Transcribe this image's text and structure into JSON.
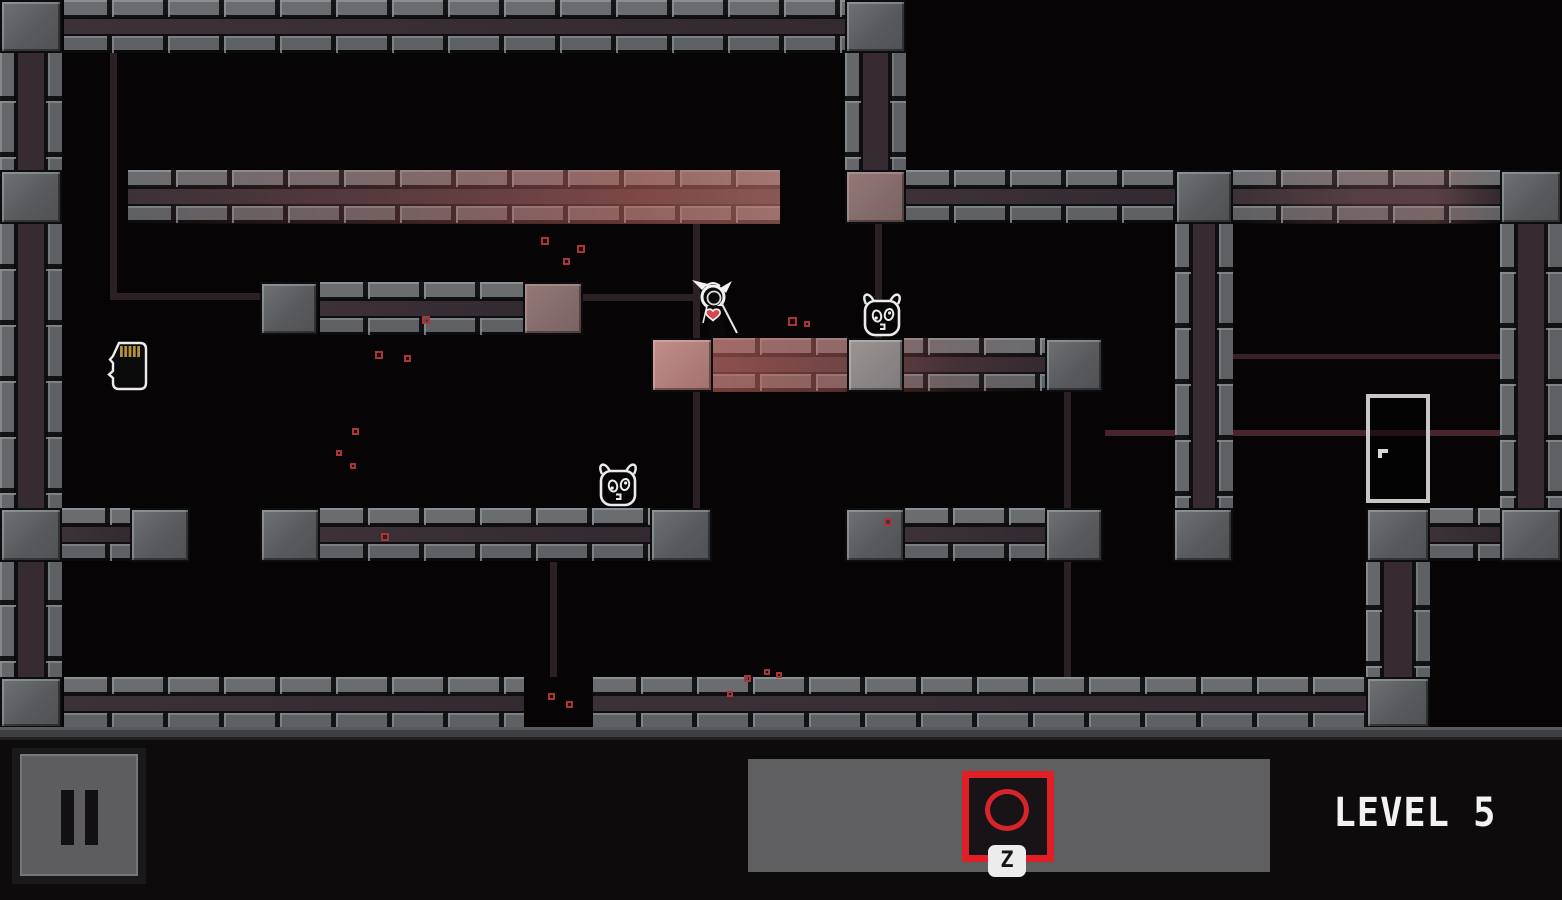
{
  "meta": {
    "width": 1562,
    "height": 900,
    "scene": "dark tiled platformer level"
  },
  "colors": {
    "background": "#060404",
    "hud_background": "#0d0b0c",
    "panel_gray": "#5f5f61",
    "accent_red": "#e11f26",
    "particle_red": "#a8353a",
    "wire_dark": "#2b2026",
    "wire_red": "#4a242c",
    "wire_red2": "#3a2028",
    "girder_gray": "#636367",
    "girder_band": "#342b31",
    "tint_pink": "#b2807c",
    "door_frame": "#c7c7c7",
    "sprite_white": "#ececec",
    "heart_red": "#d4494d",
    "pin_gold": "#b5913d"
  },
  "hud": {
    "pause_icon": "pause-icon",
    "action_icon": "circle-icon",
    "action_key": "Z",
    "level_label": "LEVEL 5"
  },
  "level": {
    "beams": [
      [
        64,
        0,
        781,
        53,
        "none"
      ],
      [
        128,
        170,
        652,
        54,
        "red-r"
      ],
      [
        906,
        170,
        269,
        54,
        "none"
      ],
      [
        1233,
        170,
        267,
        54,
        "pink-c"
      ],
      [
        320,
        282,
        203,
        53,
        "none"
      ],
      [
        712,
        338,
        333,
        54,
        "red-l"
      ],
      [
        62,
        508,
        68,
        54,
        "none"
      ],
      [
        320,
        508,
        330,
        54,
        "none"
      ],
      [
        905,
        508,
        140,
        54,
        "none"
      ],
      [
        1430,
        508,
        70,
        54,
        "none"
      ],
      [
        64,
        677,
        460,
        51,
        "none"
      ],
      [
        593,
        677,
        773,
        51,
        "none"
      ]
    ],
    "columns": [
      [
        0,
        53,
        62,
        624
      ],
      [
        845,
        53,
        61,
        117
      ],
      [
        1175,
        224,
        58,
        284
      ],
      [
        1500,
        224,
        62,
        284
      ],
      [
        1366,
        562,
        64,
        115
      ]
    ],
    "blocks": [
      [
        0,
        0,
        62,
        53,
        "gray"
      ],
      [
        845,
        0,
        61,
        53,
        "gray"
      ],
      [
        0,
        170,
        62,
        54,
        "gray"
      ],
      [
        845,
        170,
        61,
        54,
        "mauve"
      ],
      [
        1175,
        170,
        58,
        54,
        "gray"
      ],
      [
        1500,
        170,
        62,
        54,
        "gray"
      ],
      [
        260,
        282,
        58,
        53,
        "gray"
      ],
      [
        523,
        282,
        60,
        53,
        "mauve"
      ],
      [
        651,
        338,
        62,
        54,
        "pink"
      ],
      [
        847,
        338,
        57,
        54,
        "light"
      ],
      [
        1045,
        338,
        58,
        54,
        "gray"
      ],
      [
        0,
        508,
        62,
        54,
        "gray"
      ],
      [
        130,
        508,
        60,
        54,
        "gray"
      ],
      [
        260,
        508,
        60,
        54,
        "gray"
      ],
      [
        650,
        508,
        62,
        54,
        "gray"
      ],
      [
        845,
        508,
        60,
        54,
        "gray"
      ],
      [
        1045,
        508,
        58,
        54,
        "gray"
      ],
      [
        1173,
        508,
        60,
        54,
        "gray"
      ],
      [
        1366,
        508,
        64,
        54,
        "gray"
      ],
      [
        1500,
        508,
        62,
        54,
        "gray"
      ],
      [
        0,
        677,
        62,
        51,
        "gray"
      ],
      [
        1366,
        677,
        64,
        51,
        "gray"
      ]
    ],
    "wires": [
      [
        110,
        53,
        7,
        243,
        "dark"
      ],
      [
        110,
        293,
        157,
        7,
        "dark"
      ],
      [
        583,
        294,
        115,
        7,
        "dark"
      ],
      [
        693,
        224,
        7,
        114,
        "dark"
      ],
      [
        693,
        392,
        7,
        116,
        "dark"
      ],
      [
        875,
        224,
        7,
        114,
        "dark"
      ],
      [
        550,
        562,
        7,
        115,
        "dark"
      ],
      [
        1064,
        392,
        7,
        116,
        "dark"
      ],
      [
        1064,
        562,
        7,
        115,
        "dark"
      ],
      [
        1105,
        430,
        398,
        6,
        "red"
      ],
      [
        1233,
        354,
        267,
        5,
        "red2"
      ]
    ],
    "particles": [
      [
        541,
        237,
        8
      ],
      [
        577,
        245,
        8
      ],
      [
        563,
        258,
        7
      ],
      [
        422,
        316,
        8
      ],
      [
        788,
        317,
        9
      ],
      [
        804,
        321,
        6
      ],
      [
        375,
        351,
        8
      ],
      [
        404,
        355,
        7
      ],
      [
        352,
        428,
        7
      ],
      [
        336,
        450,
        6
      ],
      [
        350,
        463,
        6
      ],
      [
        381,
        533,
        8
      ],
      [
        884,
        518,
        8
      ],
      [
        744,
        675,
        7
      ],
      [
        764,
        669,
        6
      ],
      [
        727,
        691,
        6
      ],
      [
        776,
        672,
        6
      ],
      [
        548,
        693,
        7
      ],
      [
        566,
        701,
        7
      ]
    ],
    "floor": [
      0,
      727,
      1562,
      14
    ],
    "entities": {
      "player": {
        "x": 688,
        "y": 277,
        "w": 54,
        "h": 64
      },
      "enemies": [
        {
          "x": 858,
          "y": 292,
          "w": 48,
          "h": 46
        },
        {
          "x": 594,
          "y": 462,
          "w": 48,
          "h": 46
        }
      ],
      "sd_card": {
        "x": 107,
        "y": 341,
        "w": 42,
        "h": 50
      },
      "door": {
        "x": 1366,
        "y": 394,
        "w": 64,
        "h": 109
      }
    }
  }
}
